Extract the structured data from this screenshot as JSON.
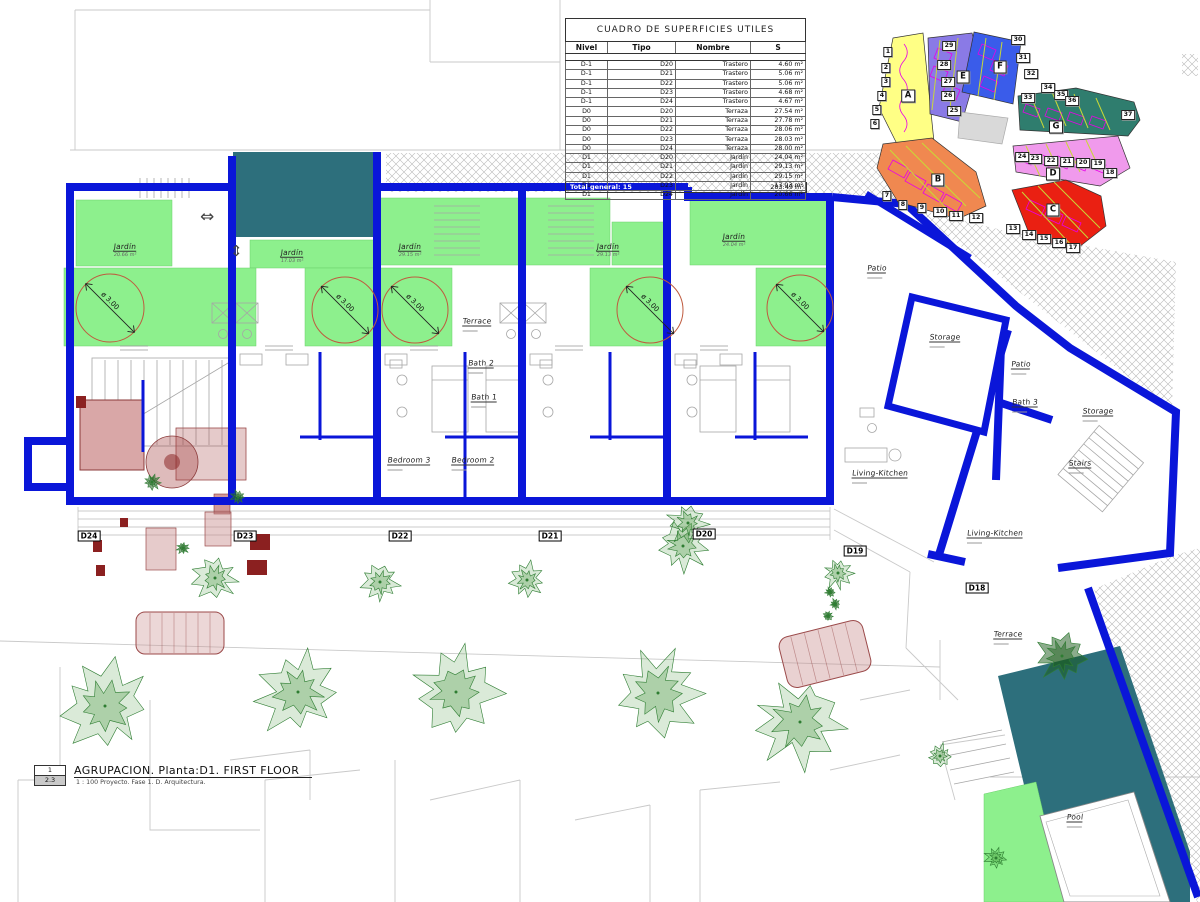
{
  "colors": {
    "wall_blue": "#0a16d9",
    "garden_green": "#8df08d",
    "deck_teal": "#2d6f7c",
    "dim_circle": "#bf5b3f",
    "key_yellow": "#ffff85",
    "key_orange": "#f08850",
    "key_red": "#ea2012",
    "key_pink": "#f09aec",
    "key_purple": "#8a7ae6",
    "key_blue": "#3a5cea",
    "key_teal": "#2f7d6e"
  },
  "schedule_table": {
    "title": "CUADRO DE SUPERFICIES UTILES",
    "headers": [
      "Nivel",
      "Tipo",
      "Nombre",
      "S"
    ],
    "rows": [
      [
        "D-1",
        "D20",
        "Trastero",
        "4.60 m²"
      ],
      [
        "D-1",
        "D21",
        "Trastero",
        "5.06 m²"
      ],
      [
        "D-1",
        "D22",
        "Trastero",
        "5.06 m²"
      ],
      [
        "D-1",
        "D23",
        "Trastero",
        "4.68 m²"
      ],
      [
        "D-1",
        "D24",
        "Trastero",
        "4.67 m²"
      ],
      [
        "D0",
        "D20",
        "Terraza",
        "27.54 m²"
      ],
      [
        "D0",
        "D21",
        "Terraza",
        "27.78 m²"
      ],
      [
        "D0",
        "D22",
        "Terraza",
        "28.06 m²"
      ],
      [
        "D0",
        "D23",
        "Terraza",
        "28.03 m²"
      ],
      [
        "D0",
        "D24",
        "Terraza",
        "28.00 m²"
      ],
      [
        "D1",
        "D20",
        "Jardín",
        "24.04 m²"
      ],
      [
        "D1",
        "D21",
        "Jardín",
        "29.13 m²"
      ],
      [
        "D1",
        "D22",
        "Jardín",
        "29.15 m²"
      ],
      [
        "D1",
        "D23",
        "Jardín",
        "17.03 m²"
      ],
      [
        "D1",
        "D24",
        "Jardín",
        "20.66 m²"
      ]
    ],
    "total_label": "Total general: 15",
    "total_value": "283.49 m²"
  },
  "title_block": {
    "detail_number": "1",
    "sheet_ref": "2.3",
    "title": "AGRUPACION. Planta:D1. FIRST FLOOR",
    "scale_line": "1 : 100 Proyecto. Fase 1. D. Arquitectura."
  },
  "plan": {
    "dim_label": "ø 3.00",
    "dim_circles": [
      {
        "x": 110,
        "y": 308,
        "r": 34
      },
      {
        "x": 345,
        "y": 310,
        "r": 33
      },
      {
        "x": 415,
        "y": 310,
        "r": 33
      },
      {
        "x": 650,
        "y": 310,
        "r": 33
      },
      {
        "x": 800,
        "y": 308,
        "r": 33
      }
    ],
    "unit_tags": [
      {
        "label": "D24",
        "x": 89,
        "y": 536
      },
      {
        "label": "D23",
        "x": 245,
        "y": 536
      },
      {
        "label": "D22",
        "x": 400,
        "y": 536
      },
      {
        "label": "D21",
        "x": 550,
        "y": 536
      },
      {
        "label": "D20",
        "x": 704,
        "y": 534
      },
      {
        "label": "D19",
        "x": 855,
        "y": 551
      },
      {
        "label": "D18",
        "x": 977,
        "y": 588
      }
    ],
    "room_labels": [
      {
        "text": "Jardín",
        "area": "20.66 m²",
        "x": 125,
        "y": 246
      },
      {
        "text": "Jardín",
        "area": "17.03 m²",
        "x": 292,
        "y": 252
      },
      {
        "text": "Jardín",
        "area": "29.15 m²",
        "x": 410,
        "y": 246
      },
      {
        "text": "Jardín",
        "area": "29.13 m²",
        "x": 608,
        "y": 246
      },
      {
        "text": "Jardín",
        "area": "24.04 m²",
        "x": 734,
        "y": 236
      },
      {
        "text": "Terrace",
        "area": "",
        "x": 477,
        "y": 320
      },
      {
        "text": "Bath 2",
        "area": "",
        "x": 481,
        "y": 362
      },
      {
        "text": "Bath 1",
        "area": "",
        "x": 484,
        "y": 396
      },
      {
        "text": "Bedroom 3",
        "area": "",
        "x": 409,
        "y": 459
      },
      {
        "text": "Bedroom 2",
        "area": "",
        "x": 473,
        "y": 459
      },
      {
        "text": "Patio",
        "area": "",
        "x": 877,
        "y": 267
      },
      {
        "text": "Storage",
        "area": "",
        "x": 945,
        "y": 336
      },
      {
        "text": "Patio",
        "area": "",
        "x": 1021,
        "y": 363
      },
      {
        "text": "Bath 3",
        "area": "",
        "x": 1025,
        "y": 401
      },
      {
        "text": "Storage",
        "area": "",
        "x": 1098,
        "y": 410
      },
      {
        "text": "Stairs",
        "area": "",
        "x": 1080,
        "y": 462
      },
      {
        "text": "Living-Kitchen",
        "area": "",
        "x": 880,
        "y": 472
      },
      {
        "text": "Living-Kitchen",
        "area": "",
        "x": 995,
        "y": 532
      },
      {
        "text": "Terrace",
        "area": "",
        "x": 1008,
        "y": 633
      },
      {
        "text": "Pool",
        "area": "",
        "x": 1075,
        "y": 816
      }
    ]
  },
  "key_plan": {
    "letters": [
      {
        "label": "A",
        "x": 908,
        "y": 96
      },
      {
        "label": "B",
        "x": 938,
        "y": 180
      },
      {
        "label": "C",
        "x": 1053,
        "y": 210
      },
      {
        "label": "D",
        "x": 1053,
        "y": 174
      },
      {
        "label": "E",
        "x": 963,
        "y": 77
      },
      {
        "label": "F",
        "x": 1000,
        "y": 67
      },
      {
        "label": "G",
        "x": 1056,
        "y": 127
      }
    ],
    "numbers": [
      {
        "label": "1",
        "x": 888,
        "y": 52
      },
      {
        "label": "2",
        "x": 886,
        "y": 68
      },
      {
        "label": "3",
        "x": 886,
        "y": 82
      },
      {
        "label": "4",
        "x": 882,
        "y": 96
      },
      {
        "label": "5",
        "x": 877,
        "y": 110
      },
      {
        "label": "6",
        "x": 875,
        "y": 124
      },
      {
        "label": "7",
        "x": 887,
        "y": 196
      },
      {
        "label": "8",
        "x": 903,
        "y": 205
      },
      {
        "label": "9",
        "x": 922,
        "y": 208
      },
      {
        "label": "10",
        "x": 940,
        "y": 212
      },
      {
        "label": "11",
        "x": 956,
        "y": 216
      },
      {
        "label": "12",
        "x": 976,
        "y": 218
      },
      {
        "label": "13",
        "x": 1013,
        "y": 229
      },
      {
        "label": "14",
        "x": 1029,
        "y": 235
      },
      {
        "label": "15",
        "x": 1044,
        "y": 239
      },
      {
        "label": "16",
        "x": 1059,
        "y": 243
      },
      {
        "label": "17",
        "x": 1073,
        "y": 248
      },
      {
        "label": "18",
        "x": 1110,
        "y": 173
      },
      {
        "label": "19",
        "x": 1098,
        "y": 164
      },
      {
        "label": "20",
        "x": 1083,
        "y": 163
      },
      {
        "label": "21",
        "x": 1067,
        "y": 162
      },
      {
        "label": "22",
        "x": 1051,
        "y": 161
      },
      {
        "label": "23",
        "x": 1035,
        "y": 159
      },
      {
        "label": "24",
        "x": 1022,
        "y": 157
      },
      {
        "label": "25",
        "x": 954,
        "y": 111
      },
      {
        "label": "26",
        "x": 948,
        "y": 96
      },
      {
        "label": "27",
        "x": 948,
        "y": 82
      },
      {
        "label": "28",
        "x": 944,
        "y": 65
      },
      {
        "label": "29",
        "x": 949,
        "y": 46
      },
      {
        "label": "30",
        "x": 1018,
        "y": 40
      },
      {
        "label": "31",
        "x": 1023,
        "y": 58
      },
      {
        "label": "32",
        "x": 1031,
        "y": 74
      },
      {
        "label": "33",
        "x": 1028,
        "y": 98
      },
      {
        "label": "34",
        "x": 1048,
        "y": 88
      },
      {
        "label": "35",
        "x": 1061,
        "y": 95
      },
      {
        "label": "36",
        "x": 1072,
        "y": 101
      },
      {
        "label": "37",
        "x": 1128,
        "y": 115
      }
    ]
  }
}
